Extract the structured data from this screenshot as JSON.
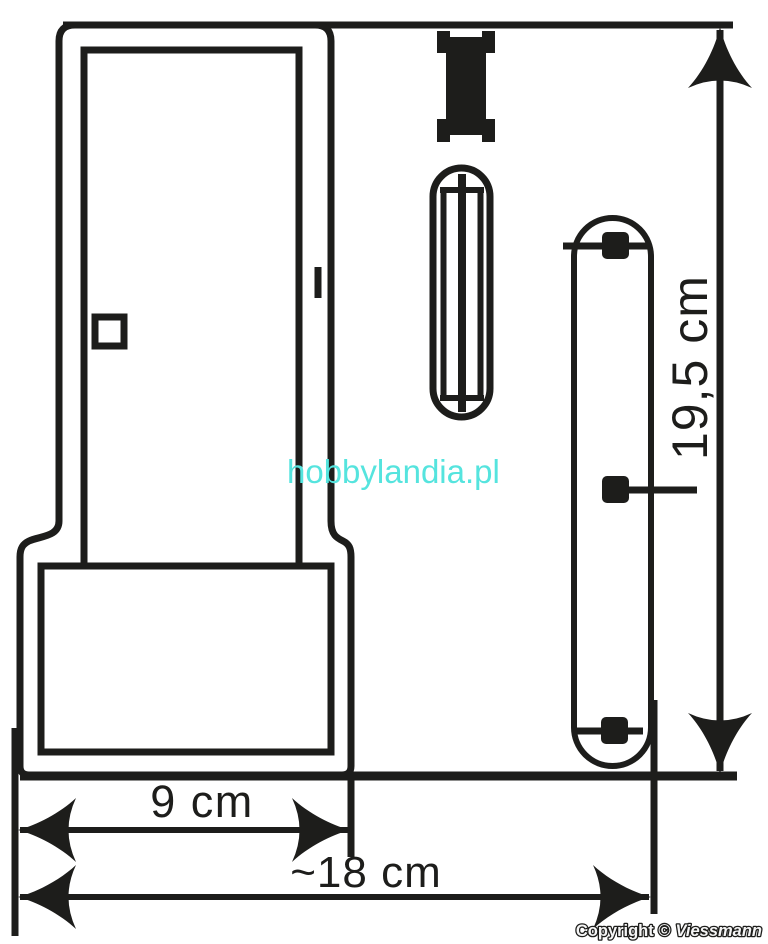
{
  "canvas": {
    "width_px": 768,
    "height_px": 944,
    "background": "#ffffff",
    "line_color": "#1d1d1b"
  },
  "dims": {
    "height": "19,5 cm",
    "base_width": "9 cm",
    "overall_width": "~18 cm"
  },
  "watermark": {
    "text": "hobbylandia.pl",
    "color": "#55e4de"
  },
  "copyright": {
    "prefix": "Copyright ©",
    "brand": "Viessmann"
  }
}
